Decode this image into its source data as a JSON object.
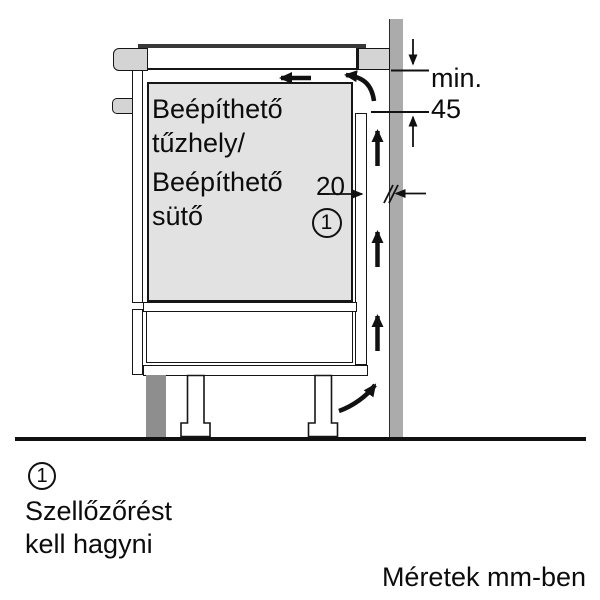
{
  "diagram": {
    "appliance_label": {
      "line1": "Beépíthető",
      "line2": "tűzhely/",
      "line3": "Beépíthető",
      "line4": "sütő"
    },
    "dimensions": {
      "min_label": "min.",
      "min_value": "45",
      "gap_value": "20"
    },
    "callout": {
      "number": "1"
    }
  },
  "legend": {
    "number": "1",
    "line1": "Szellőzőrést",
    "line2": "kell hagyni"
  },
  "footer": {
    "units_note": "Méretek mm-ben"
  },
  "colors": {
    "appliance_fill": "#e2e2e2",
    "trim_fill": "#d4d4d4",
    "wall_fill": "#ababab",
    "plinth_fill": "#8e8e8e",
    "line": "#161616"
  }
}
